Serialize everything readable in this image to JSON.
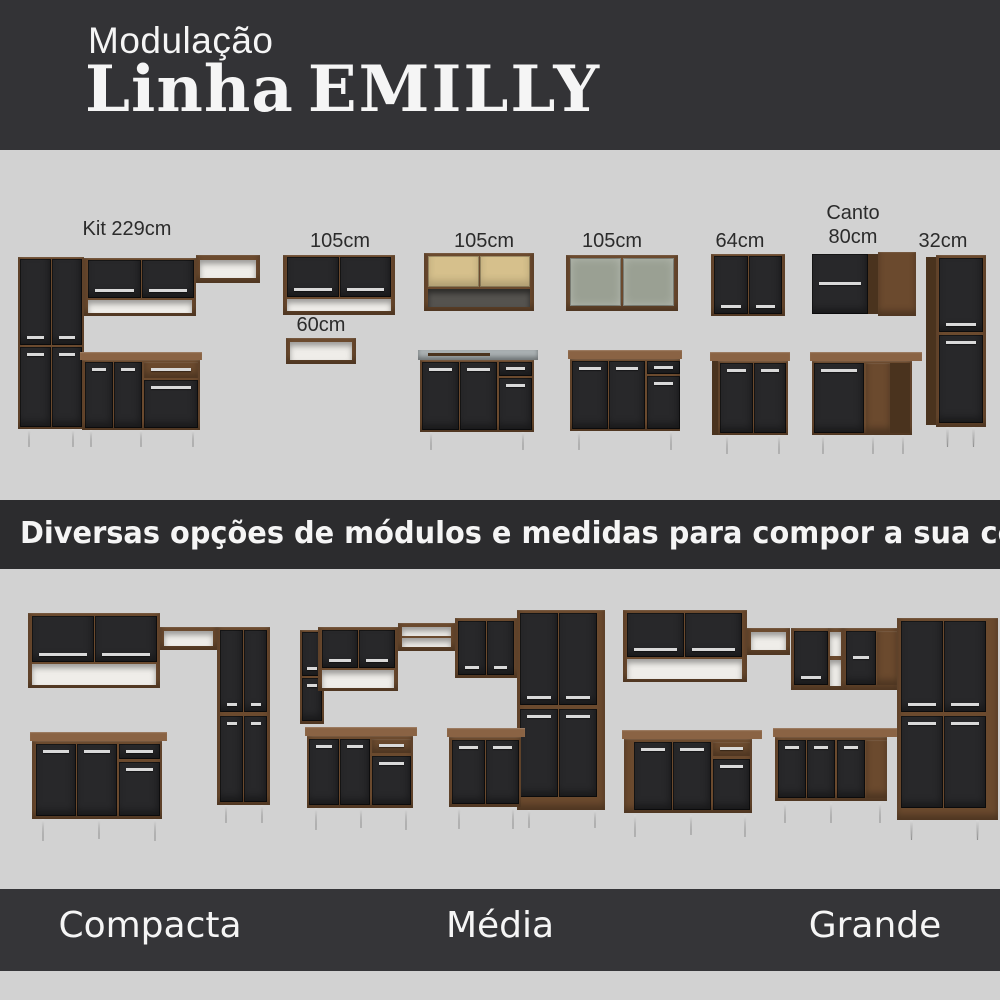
{
  "header": {
    "kicker": "Modulação",
    "title_script": "Linha",
    "title_name": "EMILLY"
  },
  "module_labels": {
    "kit": "Kit 229cm",
    "w105a": "105cm",
    "w60": "60cm",
    "w105b": "105cm",
    "w105c": "105cm",
    "w64": "64cm",
    "canto1": "Canto",
    "canto2": "80cm",
    "t32": "32cm"
  },
  "banner": {
    "text": "Diversas opções de módulos e medidas para compor a sua cozinha!"
  },
  "footer": {
    "labels": [
      "Compacta",
      "Média",
      "Grande"
    ]
  },
  "colors": {
    "header_bg": "#333336",
    "section_bg": "#d2d2d2",
    "banner_bg": "#2c2c2e",
    "footer_bg": "#353538",
    "wood": "#6b4a2e",
    "wood_dark": "#4a331e",
    "wood_light": "#8a6344",
    "door_black": "#28282a",
    "handle_silver": "#d9d9d9",
    "niche_white": "#efede9",
    "glass": "#9aa093",
    "pine": "#d6c08c",
    "steel": "#a9b0b2",
    "label_text": "#2b2b2b",
    "light_text": "#f5f5f5"
  }
}
